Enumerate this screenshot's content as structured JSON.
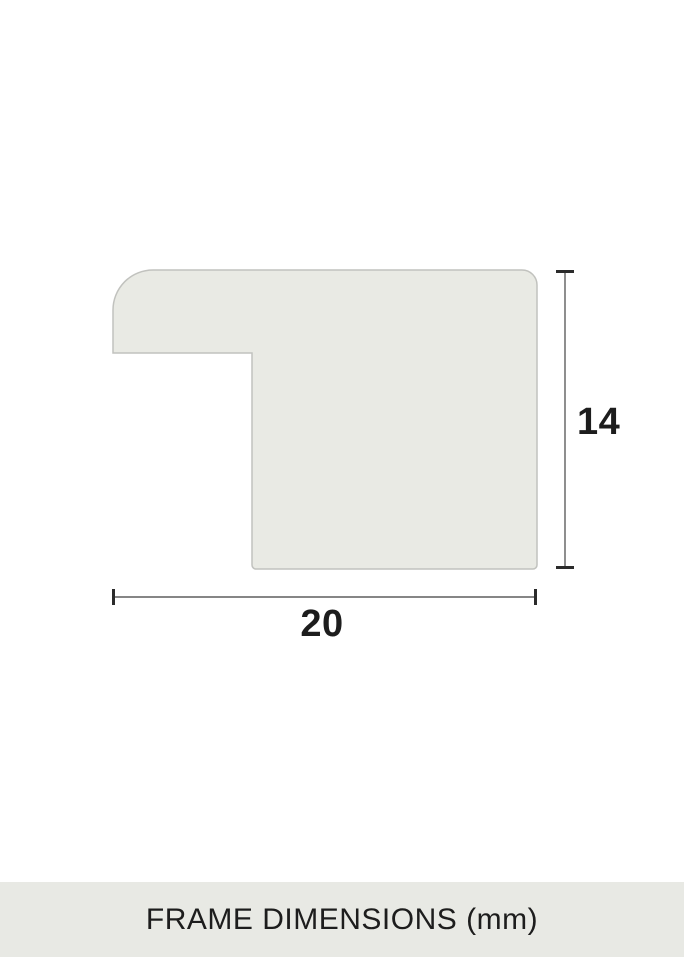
{
  "diagram": {
    "height_label": "14",
    "width_label": "20"
  },
  "footer": {
    "title": "FRAME DIMENSIONS (mm)"
  },
  "colors": {
    "page_bg": "#ffffff",
    "profile_fill": "#e9eae4",
    "profile_border": "#c1c2be",
    "dimension_line": "#5f5f5f",
    "dimension_tick": "#2b2b2b",
    "label_text": "#1d1d1d",
    "footer_bg": "#e8e9e4"
  }
}
